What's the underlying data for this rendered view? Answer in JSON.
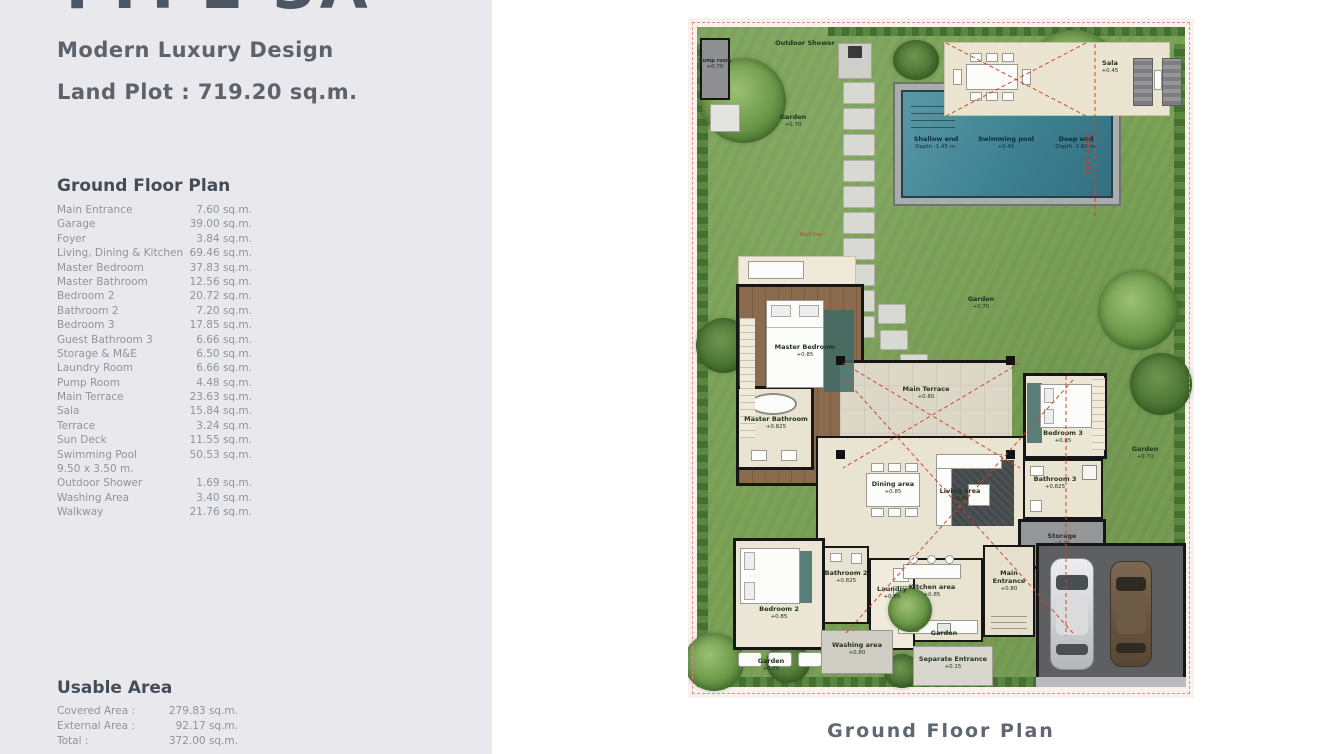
{
  "left": {
    "title": "TYPE 3A",
    "subtitle": "Modern Luxury Design",
    "land_plot": "Land Plot : 719.20 sq.m.",
    "section_title": "Ground Floor Plan",
    "rooms": [
      {
        "name": "Main Entrance",
        "area": "7.60 sq.m."
      },
      {
        "name": "Garage",
        "area": "39.00 sq.m."
      },
      {
        "name": "Foyer",
        "area": "3.84 sq.m."
      },
      {
        "name": "Living, Dining & Kitchen",
        "area": "69.46 sq.m."
      },
      {
        "name": "Master Bedroom",
        "area": "37.83 sq.m."
      },
      {
        "name": "Master Bathroom",
        "area": "12.56 sq.m."
      },
      {
        "name": "Bedroom 2",
        "area": "20.72 sq.m."
      },
      {
        "name": "Bathroom 2",
        "area": "7.20 sq.m."
      },
      {
        "name": "Bedroom 3",
        "area": "17.85 sq.m."
      },
      {
        "name": "Guest Bathroom 3",
        "area": "6.66 sq.m."
      },
      {
        "name": "Storage & M&E",
        "area": "6.50 sq.m."
      },
      {
        "name": "Laundry Room",
        "area": "6.66 sq.m."
      },
      {
        "name": "Pump Room",
        "area": "4.48 sq.m."
      },
      {
        "name": "Main Terrace",
        "area": "23.63 sq.m."
      },
      {
        "name": "Sala",
        "area": "15.84 sq.m."
      },
      {
        "name": "Terrace",
        "area": "3.24 sq.m."
      },
      {
        "name": "Sun Deck",
        "area": "11.55 sq.m."
      },
      {
        "name": "Swimming Pool",
        "area": "50.53 sq.m."
      },
      {
        "name": "9.50 x 3.50 m.",
        "area": ""
      },
      {
        "name": "Outdoor Shower",
        "area": "1.69 sq.m."
      },
      {
        "name": "Washing Area",
        "area": "3.40 sq.m."
      },
      {
        "name": "Walkway",
        "area": "21.76 sq.m."
      }
    ],
    "usable_title": "Usable Area",
    "usable": [
      {
        "name": "Covered Area :",
        "area": "279.83 sq.m."
      },
      {
        "name": "External Area :",
        "area": "92.17 sq.m."
      },
      {
        "name": "Total :",
        "area": "372.00 sq.m."
      }
    ]
  },
  "plan": {
    "caption": "Ground Floor Plan",
    "labels": {
      "pump_room": {
        "name": "Pump room",
        "level": "+0.70"
      },
      "outdoor_shower": {
        "name": "Outdoor Shower"
      },
      "garden_top": {
        "name": "Garden",
        "level": "+0.70"
      },
      "garden_mid": {
        "name": "Garden",
        "level": "+0.70"
      },
      "garden_right": {
        "name": "Garden",
        "level": "+0.70"
      },
      "garden_bottom": {
        "name": "Garden",
        "level": "+0.70"
      },
      "garden_kitchen": {
        "name": "Garden",
        "level": "+0.80"
      },
      "sala": {
        "name": "Sala",
        "level": "+0.45"
      },
      "roof_line": {
        "name": "ROOF LINE"
      },
      "roof_line_small": {
        "name": "Roof line"
      },
      "shallow_end": {
        "name": "Shallow end",
        "level": "Depth -1.45 m."
      },
      "swimming_pool": {
        "name": "Swimming pool",
        "level": "+0.45"
      },
      "deep_end": {
        "name": "Deep end",
        "level": "Depth -1.60 m."
      },
      "master_bedroom": {
        "name": "Master Bedroom",
        "level": "+0.85"
      },
      "master_bathroom": {
        "name": "Master Bathroom",
        "level": "+0.825"
      },
      "main_terrace": {
        "name": "Main Terrace",
        "level": "+0.80"
      },
      "bedroom_3": {
        "name": "Bedroom 3",
        "level": "+0.85"
      },
      "bathroom_3": {
        "name": "Bathroom 3",
        "level": "+0.825"
      },
      "dining_area": {
        "name": "Dining area",
        "level": "+0.85"
      },
      "living_area": {
        "name": "Living area",
        "level": "+0.85"
      },
      "kitchen_area": {
        "name": "Kitchen area",
        "level": "+0.85"
      },
      "storage": {
        "name": "Storage",
        "level": "+0.25"
      },
      "main_entrance": {
        "name": "Main Entrance",
        "level": "+0.80"
      },
      "bedroom_2": {
        "name": "Bedroom 2",
        "level": "+0.85"
      },
      "bathroom_2": {
        "name": "Bathroom 2",
        "level": "+0.825"
      },
      "laundry": {
        "name": "Laundry",
        "level": "+0.85"
      },
      "washing_area": {
        "name": "Washing area",
        "level": "+0.80"
      },
      "separate_entrance": {
        "name": "Separate Entrance",
        "level": "+0.15"
      }
    },
    "colors": {
      "panel_bg": "#e9e9ed",
      "garden_green": "#7ba257",
      "pool_water": "#3d8191",
      "boundary_pink": "#dc8f8f",
      "wood_floor": "#8b6b4d",
      "roof_line_red": "#c23b2a"
    }
  }
}
